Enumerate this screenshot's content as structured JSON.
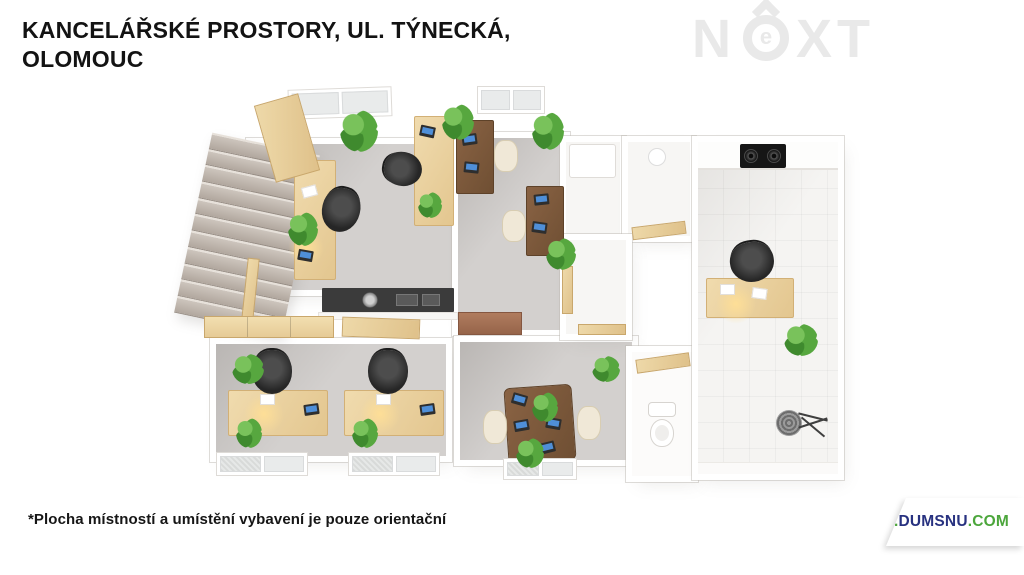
{
  "header": {
    "title_line1": "KANCELÁŘSKÉ PROSTORY, UL. TÝNECKÁ,",
    "title_line2": "OLOMOUC"
  },
  "watermark_logo": {
    "part_n": "N",
    "part_e": "e",
    "part_xt": "XT"
  },
  "floorplan": {
    "kind": "3D top-down floor plan of office premises",
    "depicted_rooms": [
      "staircase",
      "office-1",
      "kitchenette",
      "office-2-dark-desks",
      "utility-rooms",
      "office-3-two-desks",
      "meeting-room",
      "wc",
      "kitchen-bathroom-tiled-room"
    ],
    "depicted_items": [
      "stairs",
      "light-wood-desks",
      "dark-wood-desks",
      "black-office-chairs",
      "cream-chairs",
      "laptops",
      "papers",
      "plants",
      "black-kitchen-counter-with-sink",
      "wooden-sideboards",
      "open-wood-doors",
      "windows",
      "toilet",
      "wooden-shelf",
      "two-burner-cooktop",
      "shower-head",
      "desk-lamps"
    ]
  },
  "footer": {
    "disclaimer": "*Plocha místností a umístění vybavení je pouze orientační",
    "website": {
      "prefix": "WWW.",
      "name": "DUMSNU",
      "suffix": ".COM"
    }
  },
  "theme": {
    "bg": "#ffffff",
    "title-color": "#131313",
    "logo-gray": "#e9e9e9",
    "floor-gray": "#d3d0ce",
    "tile": "#f5f4f2",
    "wood-light-1": "#f0dbae",
    "wood-light-2": "#e3c68f",
    "wood-dark-1": "#8a6344",
    "wood-dark-2": "#6f4f33",
    "counter-black": "#3b3b3b",
    "chair-cream": "#f0e8d7",
    "plant-1": "#57a73f",
    "accent-green": "#4ca63c",
    "brand-navy": "#283280"
  }
}
